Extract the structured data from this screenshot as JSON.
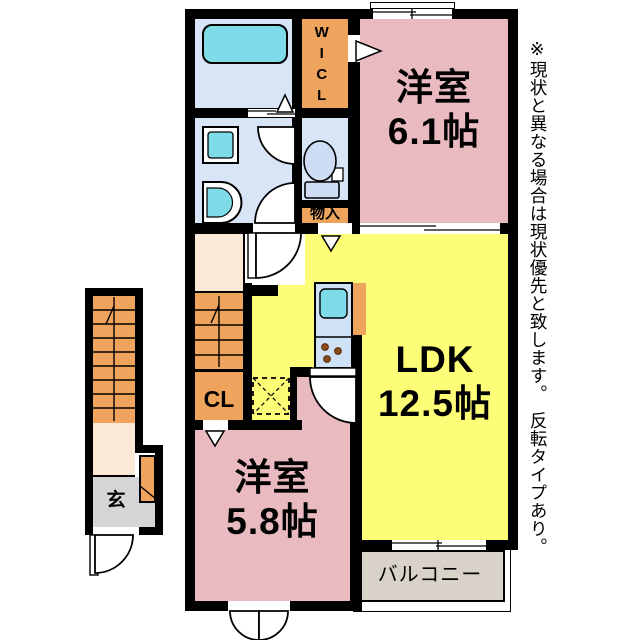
{
  "plan_title": "2F apartment floor plan",
  "rooms": {
    "bedroom1": {
      "name": "洋室",
      "size": "6.1帖"
    },
    "ldk": {
      "name": "LDK",
      "size": "12.5帖"
    },
    "bedroom2": {
      "name": "洋室",
      "size": "5.8帖"
    },
    "balcony": {
      "label": "バルコニー"
    },
    "wic": {
      "label": "WICL"
    },
    "storage": {
      "label": "物入"
    },
    "closet": {
      "label": "CL"
    },
    "entrance": {
      "label": "玄"
    }
  },
  "note": {
    "text": "※現状と異なる場合は現状優先と致します。　反転タイプあり。"
  },
  "colors": {
    "wall_black": "#000000",
    "bedroom_pink": "#e9bac0",
    "ldk_yellow": "#fdfd78",
    "storage_orange": "#efa45d",
    "hall_cream": "#fbe9d8",
    "genkan_gray": "#d5d5d7",
    "balcony_gray": "#d8d2c9",
    "bath_blue": "#d7e5f7",
    "fixture_cyan": "#7edce9",
    "toilet_blue": "#cddcf3"
  }
}
